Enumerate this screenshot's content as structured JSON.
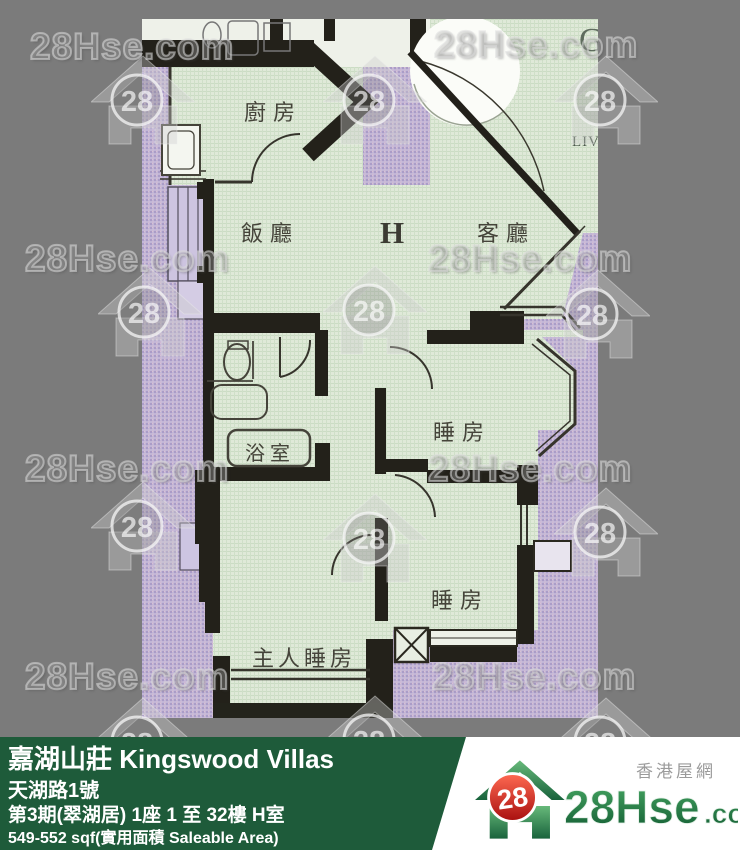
{
  "watermark": {
    "text": "28Hse.com",
    "badge": "28"
  },
  "floor_plan": {
    "unit_label": "H",
    "corner_letter": "G",
    "living_partial": "LIV",
    "rooms": {
      "kitchen": "廚房",
      "dining": "飯廳",
      "living": "客廳",
      "bathroom": "浴室",
      "bedroom_top": "睡房",
      "bedroom_bottom": "睡房",
      "master_bedroom": "主人睡房"
    }
  },
  "info_bar": {
    "estate_name": "嘉湖山莊 Kingswood Villas",
    "address": "天湖路1號",
    "block_info": "第3期(翠湖居) 1座 1 至 32樓 H室",
    "area_info": "549-552 sqf(實用面積 Saleable Area)"
  },
  "branding": {
    "site_name_zh": "香港屋網",
    "logo_main": "28Hse",
    "logo_suffix": ".com",
    "badge": "28"
  },
  "colors": {
    "bar_green": "#1e5b3a",
    "brand_green": "#1d7a42",
    "badge_red": "#c81e1e",
    "plan_mint": "#dde8d6",
    "scan_lavender": "#c0b5d5",
    "canvas_gray": "#7b7b7b"
  }
}
